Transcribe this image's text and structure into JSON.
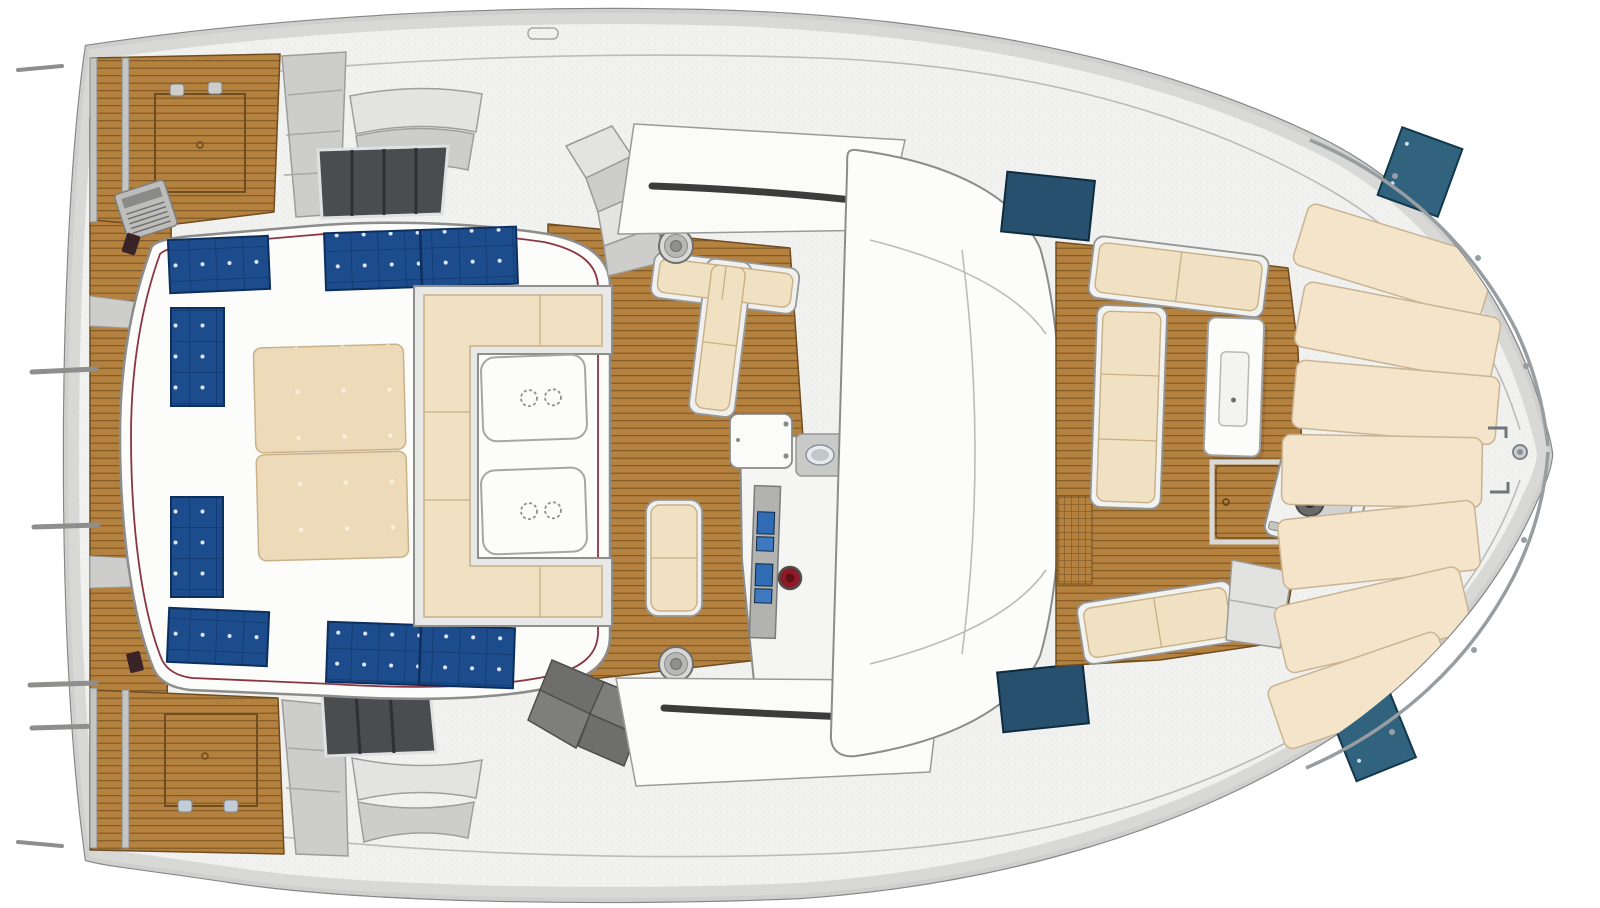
{
  "figure": {
    "kind": "catamaran-deck-plan-top-view",
    "orientation": "bow-right-stern-left",
    "width_px": 1600,
    "height_px": 908
  },
  "legend": {
    "regions": [
      {
        "name": "aft-platform",
        "desc": "teak boarding platform across the stern between hulls"
      },
      {
        "name": "aft-deck",
        "desc": "teak aft deck with storage hatches, vent console and tinted saloon windows"
      },
      {
        "name": "flybridge",
        "desc": "flybridge roof with solar panels, double sunbed, C-shaped sofa and two cupholder tables"
      },
      {
        "name": "helm-station",
        "desc": "helm with instrument displays, compass, bench seats and winches"
      },
      {
        "name": "coachroof",
        "desc": "saloon coachroof with vent slots and grab rail"
      },
      {
        "name": "forward-cockpit",
        "desc": "forward cockpit lounge with L-sofa, bench, table, deck hatch and anchor windlass"
      },
      {
        "name": "foredeck",
        "desc": "foredeck covered by fanned sunpad cushions up to the bow"
      }
    ],
    "counts": {
      "solar_panel_modules": 8,
      "sunbed_cushions": 2,
      "flybridge_tables": 2,
      "cupholders_per_table": 2,
      "winches": 2,
      "helm_displays": 4,
      "teak_deck_hatches": 3,
      "tinted_deck_hatches": 4,
      "dark_saloon_windows": 2,
      "foredeck_sunpad_sections": 7,
      "boarding_rails": 4
    }
  },
  "colors": {
    "paper": "#ffffff",
    "hull": "#f1f1ef",
    "hullEdge": "#85878a",
    "band": "#d8d8d6",
    "mold": "#b9bbbd",
    "teak": "#b5813f",
    "teakLine": "#7c5624",
    "teakDark": "#6f4d20",
    "white": "#fcfcfb",
    "cream": "#f1e1c3",
    "creamEdge": "#c7b088",
    "mattress": "#ecdab8",
    "tuftDot": "#f9f1de",
    "solar": "#1d4c8c",
    "solarGrid": "#11386e",
    "solarDot": "#dfe8f6",
    "navyHatch": "#27506e",
    "tealHatch": "#31637f",
    "windowDark": "#4a4c50",
    "slotDark": "#3c3c3c",
    "chrome": "#979da1",
    "grayLight": "#e3e3e1",
    "grayMid": "#cdcdcb",
    "grayDark": "#8e8e8c",
    "stepsDark": "#6e6e6c",
    "redTrim": "#7e1f2d",
    "redGauge": "#8c1a28",
    "screen": "#2f6cb4",
    "console": "#b2b2b0"
  }
}
